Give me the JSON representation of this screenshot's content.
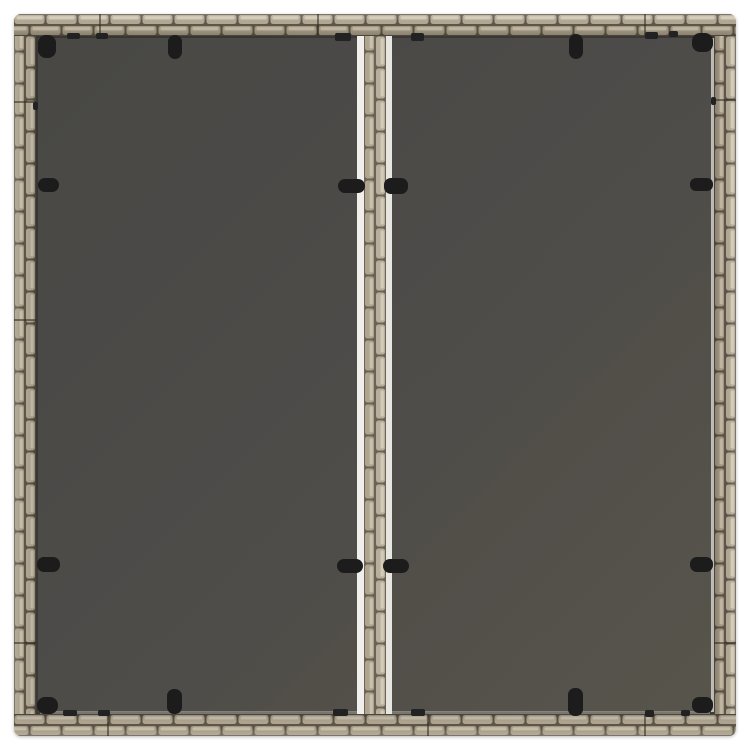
{
  "page": {
    "background_color": "#ffffff",
    "description": "Top-down product photo of a square gray poly rattan garden table with a two-panel dark glass top held by black clips"
  },
  "table": {
    "outer": {
      "x": 14,
      "y": 14,
      "size": 722,
      "corner_radius": 7,
      "band": 22
    },
    "frame_colors": {
      "gap": "#5b5346",
      "brick": "#b1a692",
      "brick_alt": "#a59a85",
      "highlight": "#d0c7b3",
      "highlight_alt": "#c5bba6"
    },
    "glass": {
      "x": 36,
      "y": 36,
      "size": 678,
      "color_dark": "#494744",
      "color_mid": "#4f4d49",
      "color_light": "#57544c",
      "edge_highlight_right": "#dcdad3",
      "edge_highlight_bottom": "#cfcdc6"
    },
    "divider": {
      "white_left": {
        "x": 357,
        "w": 7,
        "color": "#f0efeb"
      },
      "weave": {
        "x": 364,
        "w": 22,
        "tint": "rgba(255,252,244,0.10)"
      },
      "white_right": {
        "x": 386,
        "w": 6,
        "color": "#e7e6e1"
      }
    },
    "clips": {
      "color": "#1b1b1b",
      "items": [
        {
          "name": "corner-top-left",
          "x": 38,
          "y": 35,
          "w": 18,
          "h": 23,
          "r": 8
        },
        {
          "name": "top-left-panel",
          "x": 168,
          "y": 35,
          "w": 14,
          "h": 24,
          "r": 7
        },
        {
          "name": "top-right-panel",
          "x": 569,
          "y": 34,
          "w": 14,
          "h": 25,
          "r": 7
        },
        {
          "name": "corner-top-right",
          "x": 692,
          "y": 33,
          "w": 21,
          "h": 19,
          "r": 8
        },
        {
          "name": "left-upper",
          "x": 38,
          "y": 178,
          "w": 21,
          "h": 14,
          "r": 7
        },
        {
          "name": "divider-upper-left",
          "x": 338,
          "y": 179,
          "w": 27,
          "h": 14,
          "r": 7
        },
        {
          "name": "divider-upper-right",
          "x": 384,
          "y": 178,
          "w": 24,
          "h": 16,
          "r": 7
        },
        {
          "name": "right-upper",
          "x": 690,
          "y": 178,
          "w": 23,
          "h": 13,
          "r": 6
        },
        {
          "name": "left-lower",
          "x": 37,
          "y": 557,
          "w": 23,
          "h": 15,
          "r": 7
        },
        {
          "name": "divider-lower-left",
          "x": 337,
          "y": 559,
          "w": 26,
          "h": 14,
          "r": 7
        },
        {
          "name": "divider-lower-right",
          "x": 383,
          "y": 559,
          "w": 26,
          "h": 14,
          "r": 7
        },
        {
          "name": "right-lower",
          "x": 690,
          "y": 557,
          "w": 23,
          "h": 15,
          "r": 7
        },
        {
          "name": "corner-bottom-left",
          "x": 37,
          "y": 697,
          "w": 21,
          "h": 17,
          "r": 8
        },
        {
          "name": "bottom-left-panel",
          "x": 167,
          "y": 689,
          "w": 15,
          "h": 25,
          "r": 7
        },
        {
          "name": "bottom-right-panel",
          "x": 568,
          "y": 688,
          "w": 15,
          "h": 28,
          "r": 7
        },
        {
          "name": "corner-bottom-right",
          "x": 692,
          "y": 697,
          "w": 21,
          "h": 16,
          "r": 7
        }
      ]
    },
    "nubs": {
      "color": "#232323",
      "items": [
        {
          "x": 67,
          "y": 33,
          "w": 13,
          "h": 6
        },
        {
          "x": 96,
          "y": 33,
          "w": 12,
          "h": 6
        },
        {
          "x": 335,
          "y": 33,
          "w": 16,
          "h": 8
        },
        {
          "x": 411,
          "y": 33,
          "w": 13,
          "h": 8
        },
        {
          "x": 645,
          "y": 32,
          "w": 13,
          "h": 7
        },
        {
          "x": 669,
          "y": 31,
          "w": 9,
          "h": 6
        },
        {
          "x": 63,
          "y": 710,
          "w": 14,
          "h": 6
        },
        {
          "x": 98,
          "y": 710,
          "w": 12,
          "h": 6
        },
        {
          "x": 333,
          "y": 709,
          "w": 15,
          "h": 7
        },
        {
          "x": 411,
          "y": 709,
          "w": 14,
          "h": 7
        },
        {
          "x": 645,
          "y": 710,
          "w": 9,
          "h": 7
        },
        {
          "x": 681,
          "y": 710,
          "w": 9,
          "h": 6
        },
        {
          "x": 33,
          "y": 102,
          "w": 5,
          "h": 8
        },
        {
          "x": 711,
          "y": 97,
          "w": 5,
          "h": 8
        }
      ]
    },
    "seams": {
      "color": "rgba(48,40,30,0.55)",
      "top_x": [
        100,
        318,
        645
      ],
      "bottom_x": [
        108,
        428,
        645
      ],
      "left_y": [
        102,
        320,
        643
      ],
      "right_y": [
        100,
        643
      ]
    }
  }
}
